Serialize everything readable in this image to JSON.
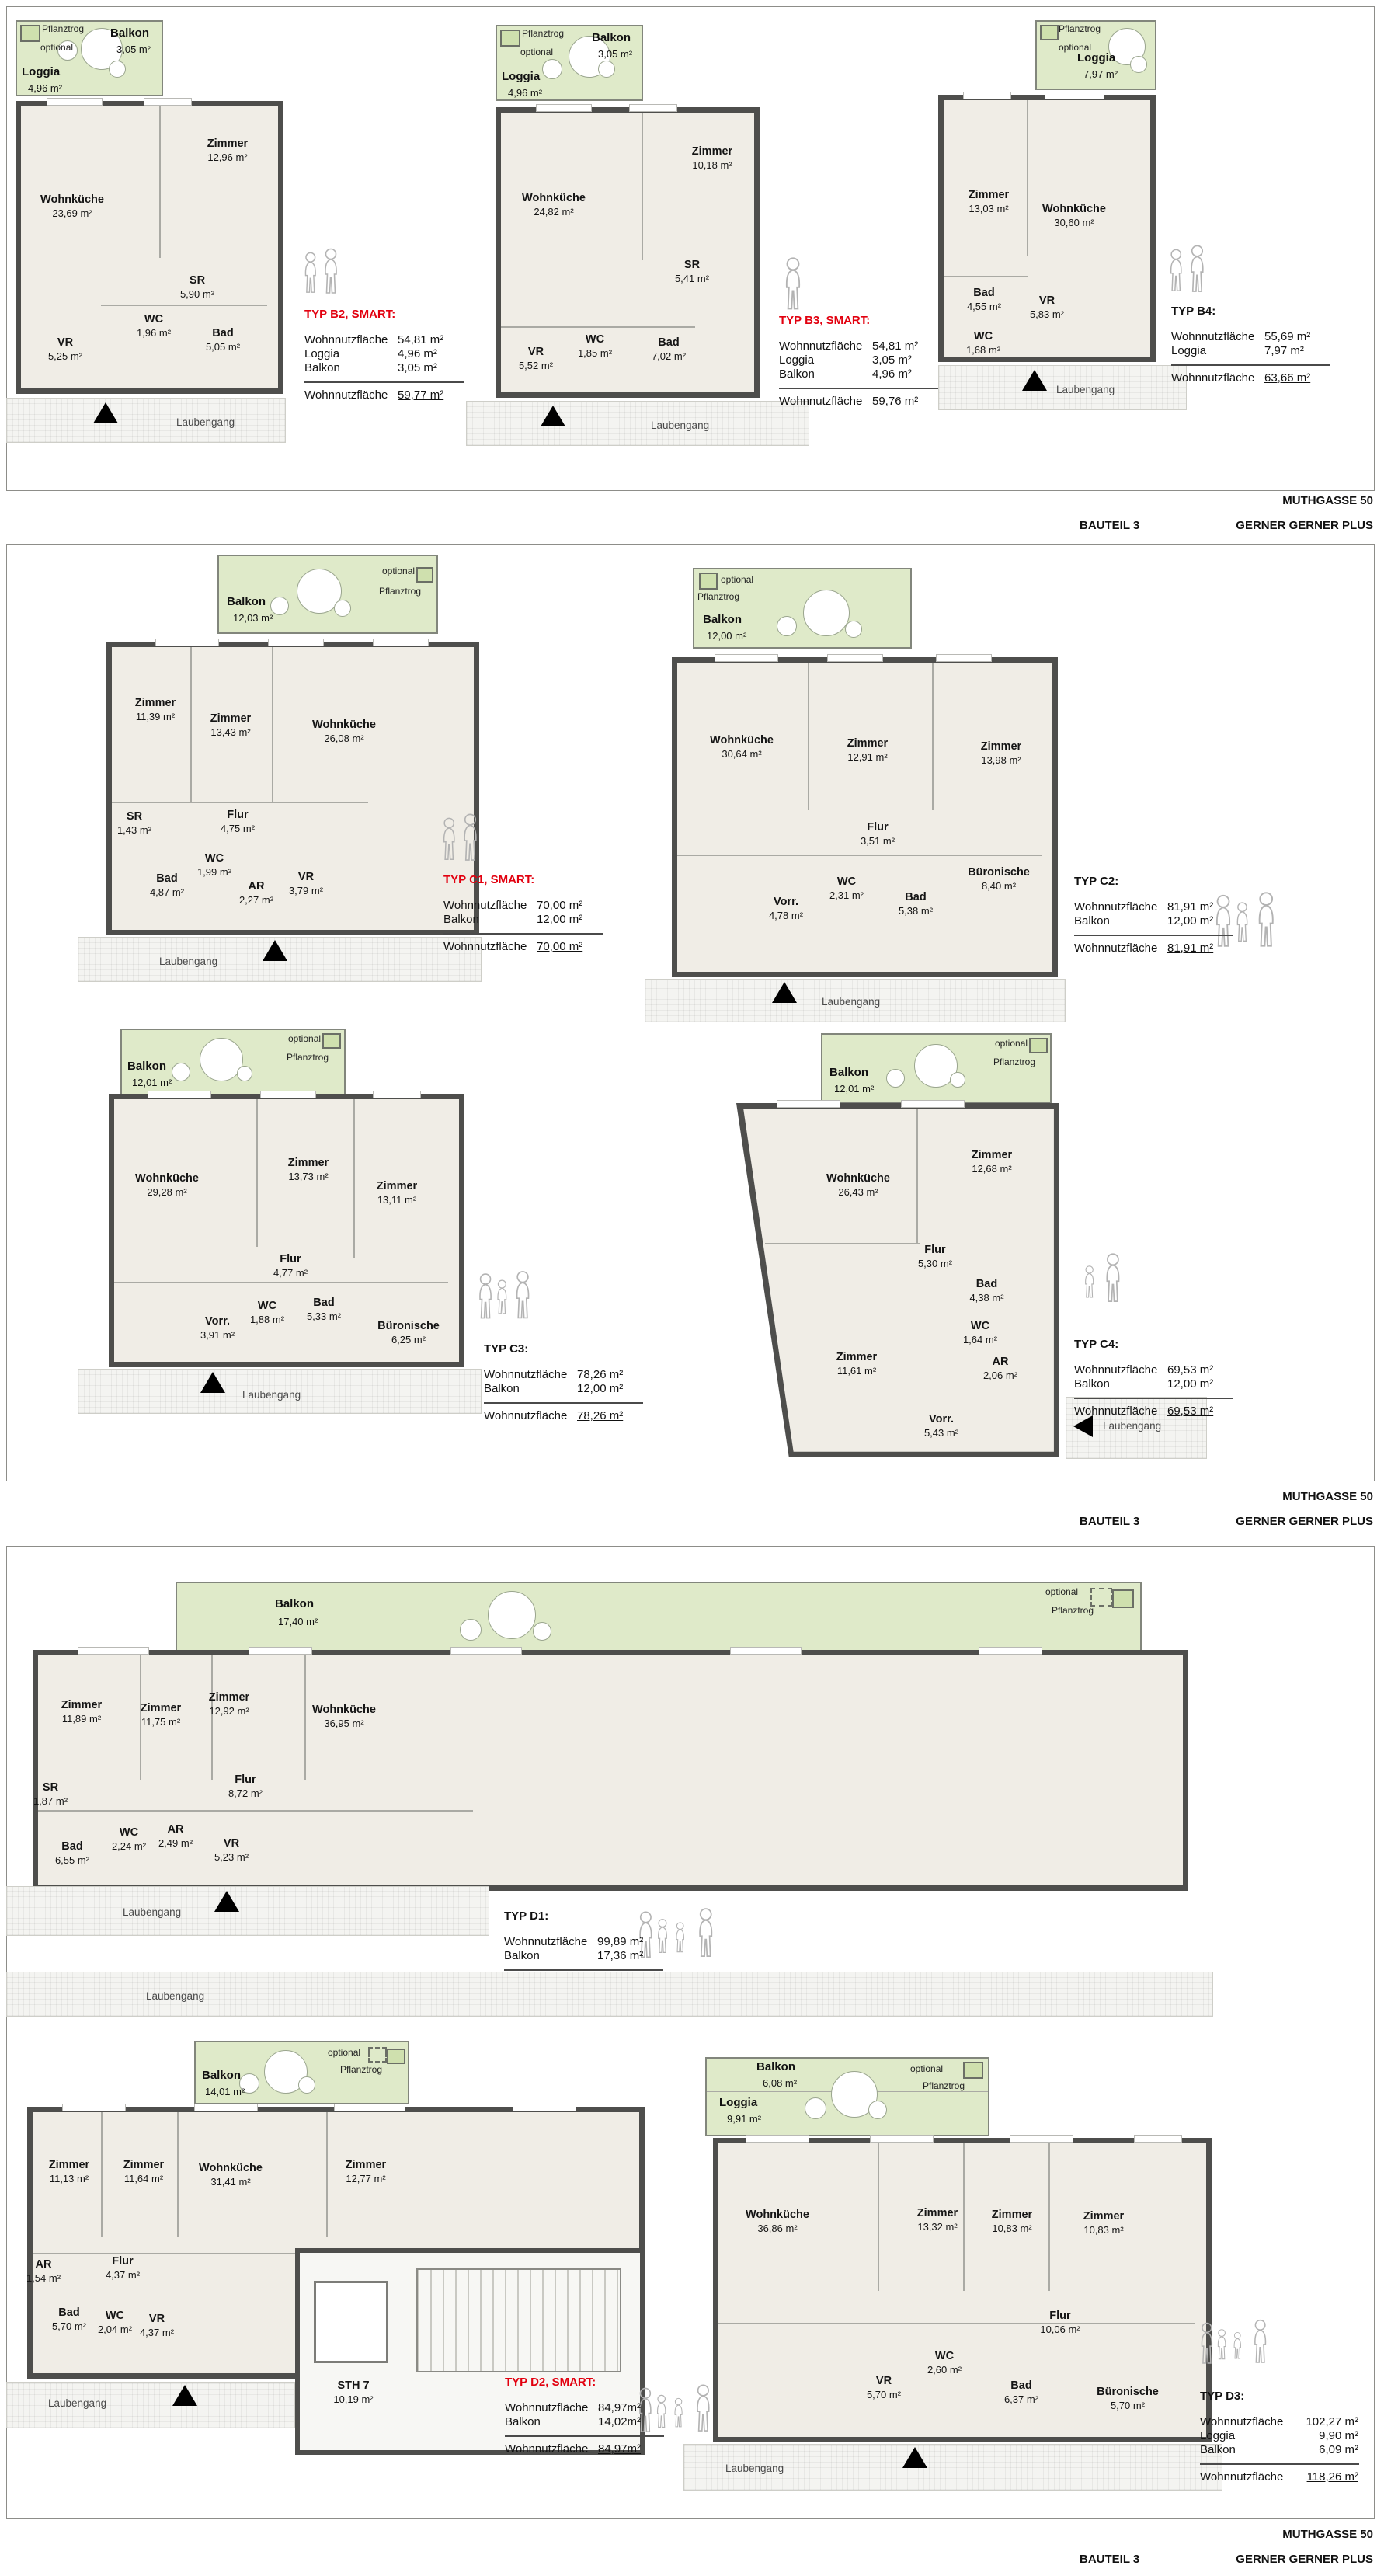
{
  "footer": {
    "project": "MUTHGASSE 50",
    "bauteil": "BAUTEIL 3",
    "architect": "GERNER GERNER PLUS"
  },
  "common": {
    "laubengang": "Laubengang",
    "optional": "optional",
    "pflanztrog": "Pflanztrog"
  },
  "plans": {
    "b2": {
      "outdoor": [
        {
          "label": "Balkon",
          "area": "3,05 m²"
        },
        {
          "label": "Loggia",
          "area": "4,96 m²"
        }
      ],
      "rooms": [
        {
          "label": "Wohnküche",
          "area": "23,69 m²"
        },
        {
          "label": "Zimmer",
          "area": "12,96 m²"
        },
        {
          "label": "SR",
          "area": "5,90 m²"
        },
        {
          "label": "WC",
          "area": "1,96 m²"
        },
        {
          "label": "Bad",
          "area": "5,05 m²"
        },
        {
          "label": "VR",
          "area": "5,25 m²"
        }
      ],
      "info": {
        "title": "TYP B2, SMART:",
        "rows": [
          {
            "label": "Wohnnutzfläche",
            "value": "54,81 m²"
          },
          {
            "label": "Loggia",
            "value": "4,96 m²"
          },
          {
            "label": "Balkon",
            "value": "3,05 m²"
          }
        ],
        "total": {
          "label": "Wohnnutzfläche",
          "value": "59,77 m²"
        }
      }
    },
    "b3": {
      "outdoor": [
        {
          "label": "Balkon",
          "area": "3,05 m²"
        },
        {
          "label": "Loggia",
          "area": "4,96 m²"
        }
      ],
      "rooms": [
        {
          "label": "Wohnküche",
          "area": "24,82 m²"
        },
        {
          "label": "Zimmer",
          "area": "10,18 m²"
        },
        {
          "label": "SR",
          "area": "5,41 m²"
        },
        {
          "label": "WC",
          "area": "1,85 m²"
        },
        {
          "label": "Bad",
          "area": "7,02 m²"
        },
        {
          "label": "VR",
          "area": "5,52 m²"
        }
      ],
      "info": {
        "title": "TYP B3, SMART:",
        "rows": [
          {
            "label": "Wohnnutzfläche",
            "value": "54,81 m²"
          },
          {
            "label": "Loggia",
            "value": "3,05 m²"
          },
          {
            "label": "Balkon",
            "value": "4,96 m²"
          }
        ],
        "total": {
          "label": "Wohnnutzfläche",
          "value": "59,76 m²"
        }
      }
    },
    "b4": {
      "outdoor": [
        {
          "label": "Loggia",
          "area": "7,97 m²"
        }
      ],
      "rooms": [
        {
          "label": "Zimmer",
          "area": "13,03 m²"
        },
        {
          "label": "Wohnküche",
          "area": "30,60 m²"
        },
        {
          "label": "Bad",
          "area": "4,55 m²"
        },
        {
          "label": "VR",
          "area": "5,83 m²"
        },
        {
          "label": "WC",
          "area": "1,68 m²"
        }
      ],
      "info": {
        "title": "TYP B4:",
        "rows": [
          {
            "label": "Wohnnutzfläche",
            "value": "55,69 m²"
          },
          {
            "label": "Loggia",
            "value": "7,97 m²"
          }
        ],
        "total": {
          "label": "Wohnnutzfläche",
          "value": "63,66 m²"
        }
      }
    },
    "c1": {
      "outdoor": [
        {
          "label": "Balkon",
          "area": "12,03 m²"
        }
      ],
      "rooms": [
        {
          "label": "Zimmer",
          "area": "11,39 m²"
        },
        {
          "label": "Zimmer",
          "area": "13,43 m²"
        },
        {
          "label": "Wohnküche",
          "area": "26,08 m²"
        },
        {
          "label": "SR",
          "area": "1,43 m²"
        },
        {
          "label": "Flur",
          "area": "4,75 m²"
        },
        {
          "label": "WC",
          "area": "1,99 m²"
        },
        {
          "label": "Bad",
          "area": "4,87 m²"
        },
        {
          "label": "AR",
          "area": "2,27 m²"
        },
        {
          "label": "VR",
          "area": "3,79 m²"
        }
      ],
      "info": {
        "title": "TYP C1, SMART:",
        "rows": [
          {
            "label": "Wohnnutzfläche",
            "value": "70,00 m²"
          },
          {
            "label": "Balkon",
            "value": "12,00 m²"
          }
        ],
        "total": {
          "label": "Wohnnutzfläche",
          "value": "70,00 m²"
        }
      }
    },
    "c2": {
      "outdoor": [
        {
          "label": "Balkon",
          "area": "12,00 m²"
        }
      ],
      "rooms": [
        {
          "label": "Wohnküche",
          "area": "30,64 m²"
        },
        {
          "label": "Zimmer",
          "area": "12,91 m²"
        },
        {
          "label": "Zimmer",
          "area": "13,98 m²"
        },
        {
          "label": "Flur",
          "area": "3,51 m²"
        },
        {
          "label": "Vorr.",
          "area": "4,78 m²"
        },
        {
          "label": "WC",
          "area": "2,31 m²"
        },
        {
          "label": "Bad",
          "area": "5,38 m²"
        },
        {
          "label": "Büronische",
          "area": "8,40 m²"
        }
      ],
      "info": {
        "title": "TYP C2:",
        "rows": [
          {
            "label": "Wohnnutzfläche",
            "value": "81,91 m²"
          },
          {
            "label": "Balkon",
            "value": "12,00 m²"
          }
        ],
        "total": {
          "label": "Wohnnutzfläche",
          "value": "81,91 m²"
        }
      }
    },
    "c3": {
      "outdoor": [
        {
          "label": "Balkon",
          "area": "12,01 m²"
        }
      ],
      "rooms": [
        {
          "label": "Wohnküche",
          "area": "29,28 m²"
        },
        {
          "label": "Zimmer",
          "area": "13,73 m²"
        },
        {
          "label": "Zimmer",
          "area": "13,11 m²"
        },
        {
          "label": "Flur",
          "area": "4,77 m²"
        },
        {
          "label": "Vorr.",
          "area": "3,91 m²"
        },
        {
          "label": "WC",
          "area": "1,88 m²"
        },
        {
          "label": "Bad",
          "area": "5,33 m²"
        },
        {
          "label": "Büronische",
          "area": "6,25 m²"
        }
      ],
      "info": {
        "title": "TYP C3:",
        "rows": [
          {
            "label": "Wohnnutzfläche",
            "value": "78,26 m²"
          },
          {
            "label": "Balkon",
            "value": "12,00 m²"
          }
        ],
        "total": {
          "label": "Wohnnutzfläche",
          "value": "78,26 m²"
        }
      }
    },
    "c4": {
      "outdoor": [
        {
          "label": "Balkon",
          "area": "12,01 m²"
        }
      ],
      "rooms": [
        {
          "label": "Wohnküche",
          "area": "26,43 m²"
        },
        {
          "label": "Zimmer",
          "area": "12,68 m²"
        },
        {
          "label": "Flur",
          "area": "5,30 m²"
        },
        {
          "label": "Bad",
          "area": "4,38 m²"
        },
        {
          "label": "WC",
          "area": "1,64 m²"
        },
        {
          "label": "AR",
          "area": "2,06 m²"
        },
        {
          "label": "Zimmer",
          "area": "11,61 m²"
        },
        {
          "label": "Vorr.",
          "area": "5,43 m²"
        }
      ],
      "info": {
        "title": "TYP C4:",
        "rows": [
          {
            "label": "Wohnnutzfläche",
            "value": "69,53 m²"
          },
          {
            "label": "Balkon",
            "value": "12,00 m²"
          }
        ],
        "total": {
          "label": "Wohnnutzfläche",
          "value": "69,53 m²"
        }
      }
    },
    "d1": {
      "outdoor": [
        {
          "label": "Balkon",
          "area": "17,40 m²"
        }
      ],
      "rooms": [
        {
          "label": "Zimmer",
          "area": "11,89 m²"
        },
        {
          "label": "Zimmer",
          "area": "11,75 m²"
        },
        {
          "label": "Zimmer",
          "area": "12,92 m²"
        },
        {
          "label": "Wohnküche",
          "area": "36,95 m²"
        },
        {
          "label": "SR",
          "area": "1,87 m²"
        },
        {
          "label": "Flur",
          "area": "8,72 m²"
        },
        {
          "label": "WC",
          "area": "2,24 m²"
        },
        {
          "label": "AR",
          "area": "2,49 m²"
        },
        {
          "label": "Bad",
          "area": "6,55 m²"
        },
        {
          "label": "VR",
          "area": "5,23 m²"
        }
      ],
      "info": {
        "title": "TYP D1:",
        "rows": [
          {
            "label": "Wohnnutzfläche",
            "value": "99,89 m²"
          },
          {
            "label": "Balkon",
            "value": "17,36 m²"
          }
        ],
        "total": {
          "label": "Wohnnutzfläche",
          "value": "99,89 m²"
        }
      }
    },
    "d2": {
      "outdoor": [
        {
          "label": "Balkon",
          "area": "14,01 m²"
        }
      ],
      "rooms": [
        {
          "label": "Zimmer",
          "area": "11,13 m²"
        },
        {
          "label": "Zimmer",
          "area": "11,64 m²"
        },
        {
          "label": "Wohnküche",
          "area": "31,41 m²"
        },
        {
          "label": "Zimmer",
          "area": "12,77 m²"
        },
        {
          "label": "AR",
          "area": "1,54 m²"
        },
        {
          "label": "Flur",
          "area": "4,37 m²"
        },
        {
          "label": "Bad",
          "area": "5,70 m²"
        },
        {
          "label": "WC",
          "area": "2,04 m²"
        },
        {
          "label": "VR",
          "area": "4,37 m²"
        },
        {
          "label": "STH 7",
          "area": "10,19 m²"
        }
      ],
      "info": {
        "title": "TYP D2, SMART:",
        "rows": [
          {
            "label": "Wohnnutzfläche",
            "value": "84,97m²"
          },
          {
            "label": "Balkon",
            "value": "14,02m²"
          }
        ],
        "total": {
          "label": "Wohnnutzfläche",
          "value": "84,97m²"
        }
      }
    },
    "d3": {
      "outdoor": [
        {
          "label": "Balkon",
          "area": "6,08 m²"
        },
        {
          "label": "Loggia",
          "area": "9,91 m²"
        }
      ],
      "rooms": [
        {
          "label": "Wohnküche",
          "area": "36,86 m²"
        },
        {
          "label": "Zimmer",
          "area": "13,32 m²"
        },
        {
          "label": "Zimmer",
          "area": "10,83 m²"
        },
        {
          "label": "Zimmer",
          "area": "10,83 m²"
        },
        {
          "label": "Flur",
          "area": "10,06 m²"
        },
        {
          "label": "VR",
          "area": "5,70 m²"
        },
        {
          "label": "WC",
          "area": "2,60 m²"
        },
        {
          "label": "Bad",
          "area": "6,37 m²"
        },
        {
          "label": "Büronische",
          "area": "5,70 m²"
        }
      ],
      "info": {
        "title": "TYP D3:",
        "rows": [
          {
            "label": "Wohnnutzfläche",
            "value": "102,27 m²"
          },
          {
            "label": "Loggia",
            "value": "9,90 m²"
          },
          {
            "label": "Balkon",
            "value": "6,09 m²"
          }
        ],
        "total": {
          "label": "Wohnnutzfläche",
          "value": "118,26 m²"
        }
      }
    }
  }
}
